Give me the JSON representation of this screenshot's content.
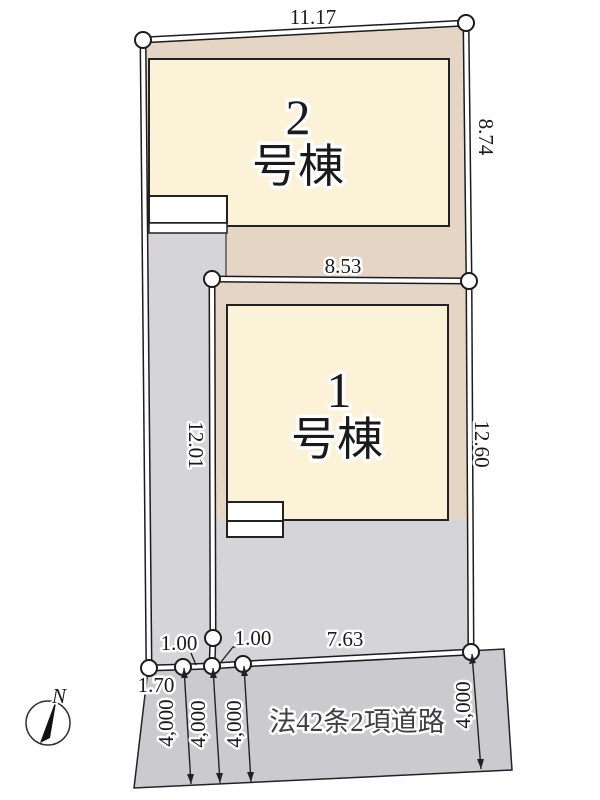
{
  "plan": {
    "title": "site-layout-plan",
    "buildings": [
      {
        "number": "1",
        "suffix": "号棟"
      },
      {
        "number": "2",
        "suffix": "号棟"
      }
    ],
    "dimensions": {
      "top_width": "11.17",
      "upper_right_depth": "8.74",
      "between_lots": "8.53",
      "left_depth": "12.01",
      "lower_right_depth": "12.60",
      "frontage_seg_a": "1.00",
      "frontage_seg_b": "1.00",
      "frontage_main": "7.63",
      "frontage_offset": "1.70",
      "road_width": "4,000"
    },
    "road": {
      "name": "法42条2項道路"
    },
    "compass": {
      "label": "N"
    },
    "colors": {
      "lot_beige": "#e5d5c4",
      "building_cream": "#fcf2d8",
      "driveway_gray": "#d5d5d9",
      "road_gray": "#cbcbcf"
    }
  }
}
